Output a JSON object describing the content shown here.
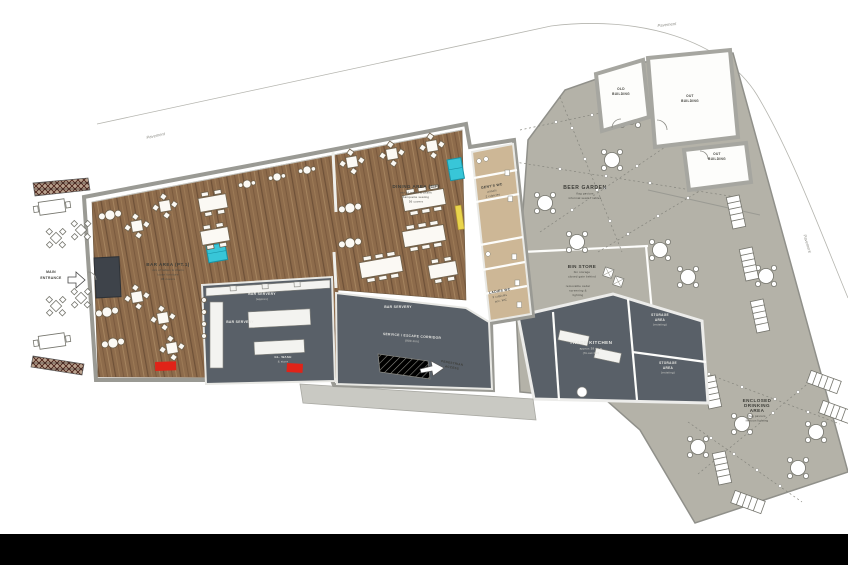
{
  "colors": {
    "garden_gray": "#b4b2a8",
    "floor_wood": "#8d6b4b",
    "kitchen_slate": "#596068",
    "toilet_tan": "#cdb796",
    "accent_cyan": "#38c6d8",
    "accent_red": "#e02318",
    "accent_yellow": "#e9d44c",
    "footer_black": "#000000"
  },
  "streets": {
    "pavement_top": "Pavement",
    "pavement_ne": "Pavement",
    "pavement_east": "Pavement"
  },
  "entrance": {
    "line1": "MAIN",
    "line2": "ENTRANCE"
  },
  "rooms": {
    "bar_area": {
      "title": "BAR AREA (PT.1)",
      "subs": [
        "mix of tables & chairs",
        "loose furniture",
        "38 covers"
      ]
    },
    "dining_area": {
      "title": "DINING AREA (GF)",
      "subs": [
        "mix of tables & chairs",
        "banquette seating",
        "56 covers"
      ]
    },
    "bar_servery": {
      "title": "BAR SERVERY",
      "sub": "(approx)"
    },
    "glass_wash": {
      "title": "GL. WASH",
      "sub": "& store"
    },
    "service_corridor": {
      "title": "SERVICE / ESCAPE CORRIDOR",
      "sub": "(900 min)"
    },
    "pedestrian_access": {
      "line1": "PEDESTRIAN",
      "line2": "ACCESS"
    },
    "gents_wc": {
      "title": "GENT'S WC",
      "subs": [
        "urinals",
        "2 cubicles"
      ]
    },
    "ladies_wc": {
      "title": "LADIES WC",
      "subs": [
        "3 cubicles",
        "acc. WC"
      ]
    },
    "beer_garden": {
      "title": "BEER GARDEN",
      "subs": [
        "flag paviors",
        "informal seats / tables"
      ]
    },
    "bin_store": {
      "title": "BIN STORE",
      "subs": [
        "bin storage",
        "closed gate behind"
      ],
      "subs2": [
        "removable cedar",
        "screening &",
        "lighting"
      ]
    },
    "old_building": {
      "line1": "OLD",
      "line2": "BUILDING"
    },
    "out_building_1": {
      "line1": "OUT",
      "line2": "BUILDING"
    },
    "out_building_2": {
      "line1": "OUT",
      "line2": "BUILDING"
    },
    "trade_kitchen": {
      "title": "TRADE KITCHEN",
      "subs": [
        "approx 38 sq.m",
        "(fit-out tbc)"
      ]
    },
    "storage_area_1": {
      "line1": "STORAGE",
      "line2": "AREA",
      "sub": "(existing)"
    },
    "storage_area_2": {
      "line1": "STORAGE",
      "line2": "AREA",
      "sub": "(existing)"
    },
    "enclosed_area": {
      "line1": "ENCLOSED",
      "line2": "DRINKING",
      "line3": "AREA",
      "subs": [
        "flag paviors",
        "festoon lighting"
      ]
    }
  }
}
